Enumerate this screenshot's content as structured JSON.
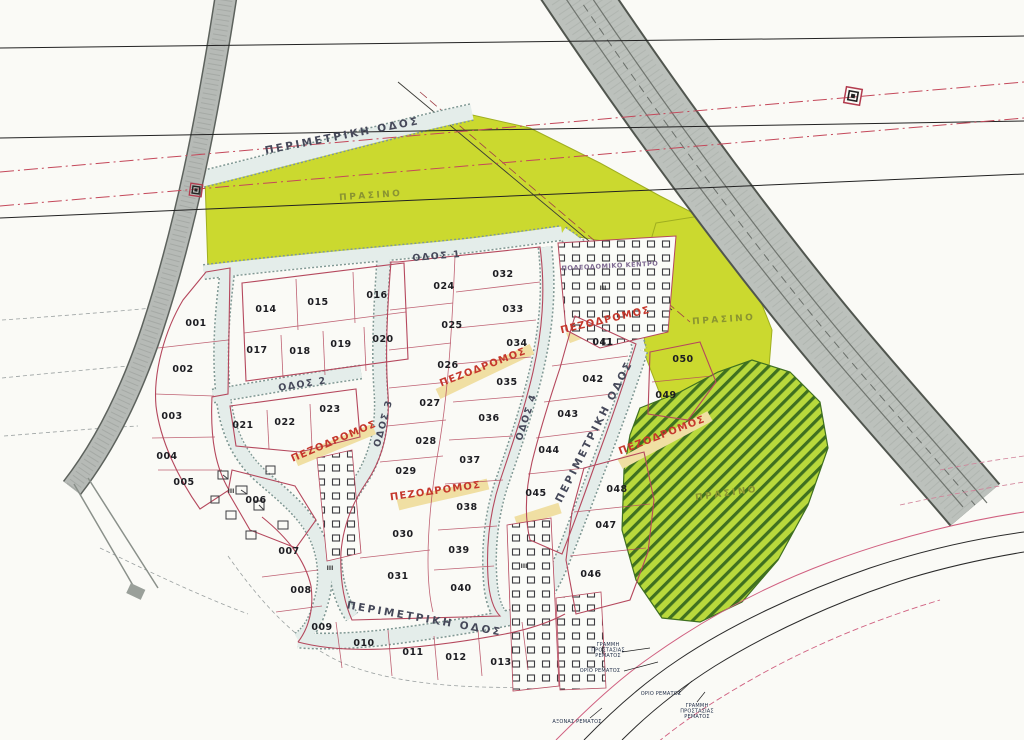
{
  "map": {
    "colors": {
      "green_area": "#cbd92f",
      "hatch_line": "#3f7020",
      "road_gray": "#bcc1bc",
      "plot_line": "#b5485d",
      "pedestrian_band": "#f0dfa3",
      "pedestrian_text": "#c5372c",
      "powerline_red": "#c4485a",
      "road_label": "#46495a",
      "green_label": "#8a9431"
    },
    "road_labels": [
      {
        "id": "perimeter-top",
        "text": "ΠΕΡΙΜΕΤΡΙΚΗ ΟΔΟΣ",
        "x": 343,
        "y": 139,
        "rot": -11,
        "cls": "lbl-road"
      },
      {
        "id": "odos-1",
        "text": "ΟΔΟΣ 1",
        "x": 437,
        "y": 259,
        "rot": -5,
        "cls": "lbl-road-sm"
      },
      {
        "id": "odos-2",
        "text": "ΟΔΟΣ 2",
        "x": 303,
        "y": 387,
        "rot": -9,
        "cls": "lbl-road-sm"
      },
      {
        "id": "odos-3",
        "text": "ΟΔΟΣ 3",
        "x": 386,
        "y": 424,
        "rot": -75,
        "cls": "lbl-road-sm"
      },
      {
        "id": "odos-4",
        "text": "ΟΔΟΣ 4",
        "x": 529,
        "y": 418,
        "rot": -72,
        "cls": "lbl-road-sm"
      },
      {
        "id": "perimeter-right",
        "text": "ΠΕΡΙΜΕΤΡΙΚΗ ΟΔΟΣ",
        "x": 597,
        "y": 433,
        "rot": -63,
        "cls": "lbl-road"
      },
      {
        "id": "perimeter-bottom",
        "text": "ΠΕΡΙΜΕΤΡΙΚΗ ΟΔΟΣ",
        "x": 424,
        "y": 622,
        "rot": 10,
        "cls": "lbl-road"
      }
    ],
    "pedestrian_labels": [
      {
        "text": "ΠΕΖΟΔΡΟΜΟΣ",
        "x": 335,
        "y": 444,
        "rot": -23
      },
      {
        "text": "ΠΕΖΟΔΡΟΜΟΣ",
        "x": 484,
        "y": 370,
        "rot": -21
      },
      {
        "text": "ΠΕΖΟΔΡΟΜΟΣ",
        "x": 436,
        "y": 494,
        "rot": -8
      },
      {
        "text": "ΠΕΖΟΔΡΟΜΟΣ",
        "x": 606,
        "y": 323,
        "rot": -13
      },
      {
        "text": "ΠΕΖΟΔΡΟΜΟΣ",
        "x": 663,
        "y": 438,
        "rot": -21
      }
    ],
    "area_labels": [
      {
        "text": "ΠΡΑΣΙΝΟ",
        "x": 371,
        "y": 198,
        "rot": -4,
        "cls": "lbl-green"
      },
      {
        "text": "ΠΡΑΣΙΝΟ",
        "x": 724,
        "y": 322,
        "rot": -4,
        "cls": "lbl-green"
      },
      {
        "text": "ΠΡΑΣΙΝΟ",
        "x": 727,
        "y": 496,
        "rot": -8,
        "cls": "lbl-green"
      },
      {
        "text": "ΠΟΛΕΟΔΟΜΙΚΟ ΚΕΝΤΡΟ",
        "x": 610,
        "y": 268,
        "rot": -3,
        "cls": "lbl-block"
      }
    ],
    "marks": [
      {
        "text": "III",
        "x": 603,
        "y": 290
      },
      {
        "text": "III",
        "x": 524,
        "y": 568
      },
      {
        "text": "III",
        "x": 231,
        "y": 493
      },
      {
        "text": "III",
        "x": 330,
        "y": 570
      }
    ],
    "plots": [
      {
        "n": "001",
        "x": 196,
        "y": 326
      },
      {
        "n": "002",
        "x": 183,
        "y": 372
      },
      {
        "n": "003",
        "x": 172,
        "y": 419
      },
      {
        "n": "004",
        "x": 167,
        "y": 459
      },
      {
        "n": "005",
        "x": 184,
        "y": 485
      },
      {
        "n": "006",
        "x": 256,
        "y": 503
      },
      {
        "n": "007",
        "x": 289,
        "y": 554
      },
      {
        "n": "008",
        "x": 301,
        "y": 593
      },
      {
        "n": "009",
        "x": 322,
        "y": 630
      },
      {
        "n": "010",
        "x": 364,
        "y": 646
      },
      {
        "n": "011",
        "x": 413,
        "y": 655
      },
      {
        "n": "012",
        "x": 456,
        "y": 660
      },
      {
        "n": "013",
        "x": 501,
        "y": 665
      },
      {
        "n": "014",
        "x": 266,
        "y": 312
      },
      {
        "n": "015",
        "x": 318,
        "y": 305
      },
      {
        "n": "016",
        "x": 377,
        "y": 298
      },
      {
        "n": "017",
        "x": 257,
        "y": 353
      },
      {
        "n": "018",
        "x": 300,
        "y": 354
      },
      {
        "n": "019",
        "x": 341,
        "y": 347
      },
      {
        "n": "020",
        "x": 383,
        "y": 342
      },
      {
        "n": "021",
        "x": 243,
        "y": 428
      },
      {
        "n": "022",
        "x": 285,
        "y": 425
      },
      {
        "n": "023",
        "x": 330,
        "y": 412
      },
      {
        "n": "024",
        "x": 444,
        "y": 289
      },
      {
        "n": "025",
        "x": 452,
        "y": 328
      },
      {
        "n": "026",
        "x": 448,
        "y": 368
      },
      {
        "n": "027",
        "x": 430,
        "y": 406
      },
      {
        "n": "028",
        "x": 426,
        "y": 444
      },
      {
        "n": "029",
        "x": 406,
        "y": 474
      },
      {
        "n": "030",
        "x": 403,
        "y": 537
      },
      {
        "n": "031",
        "x": 398,
        "y": 579
      },
      {
        "n": "032",
        "x": 503,
        "y": 277
      },
      {
        "n": "033",
        "x": 513,
        "y": 312
      },
      {
        "n": "034",
        "x": 517,
        "y": 346
      },
      {
        "n": "035",
        "x": 507,
        "y": 385
      },
      {
        "n": "036",
        "x": 489,
        "y": 421
      },
      {
        "n": "037",
        "x": 470,
        "y": 463
      },
      {
        "n": "038",
        "x": 467,
        "y": 510
      },
      {
        "n": "039",
        "x": 459,
        "y": 553
      },
      {
        "n": "040",
        "x": 461,
        "y": 591
      },
      {
        "n": "041",
        "x": 603,
        "y": 345
      },
      {
        "n": "042",
        "x": 593,
        "y": 382
      },
      {
        "n": "043",
        "x": 568,
        "y": 417
      },
      {
        "n": "044",
        "x": 549,
        "y": 453
      },
      {
        "n": "045",
        "x": 536,
        "y": 496
      },
      {
        "n": "046",
        "x": 591,
        "y": 577
      },
      {
        "n": "047",
        "x": 606,
        "y": 528
      },
      {
        "n": "048",
        "x": 617,
        "y": 492
      },
      {
        "n": "049",
        "x": 666,
        "y": 398
      },
      {
        "n": "050",
        "x": 683,
        "y": 362
      }
    ],
    "annotations": [
      {
        "lines": [
          "ΓΡΑΜΜΗ",
          "ΠΡΟΣΤΑΣΙΑΣ",
          "ΡΕΜΑΤΟΣ"
        ],
        "x": 608,
        "y": 646
      },
      {
        "lines": [
          "ΟΡΙΟ ΡΕΜΑΤΟΣ"
        ],
        "x": 600,
        "y": 672
      },
      {
        "lines": [
          "ΟΡΙΟ ΡΕΜΑΤΟΣ"
        ],
        "x": 661,
        "y": 695
      },
      {
        "lines": [
          "ΓΡΑΜΜΗ",
          "ΠΡΟΣΤΑΣΙΑΣ",
          "ΡΕΜΑΤΟΣ"
        ],
        "x": 697,
        "y": 707
      },
      {
        "lines": [
          "ΑΞΟΝΑΣ ΡΕΜΑΤΟΣ"
        ],
        "x": 577,
        "y": 723
      }
    ]
  }
}
